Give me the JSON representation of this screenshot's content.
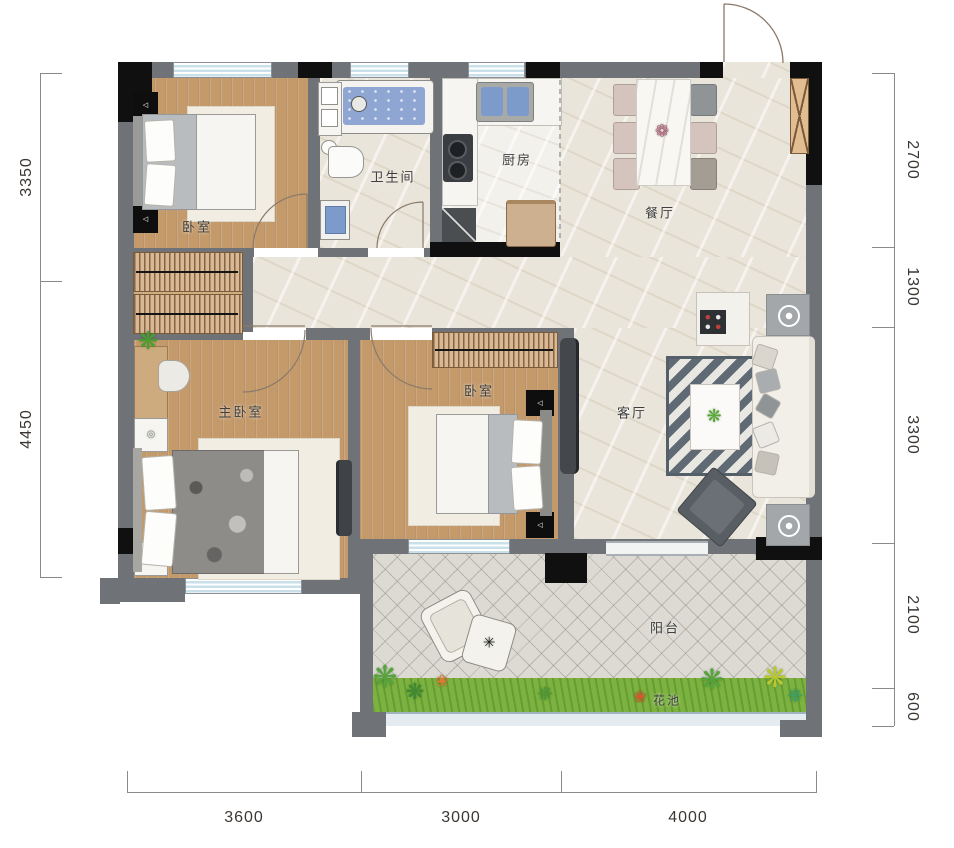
{
  "rooms": {
    "bedroom_top": "卧室",
    "bathroom": "卫生间",
    "kitchen": "厨房",
    "dining": "餐厅",
    "master_bedroom": "主卧室",
    "bedroom_mid": "卧室",
    "living_room": "客厅",
    "balcony": "阳台",
    "flower_bed": "花池"
  },
  "dimensions": {
    "left": [
      "3350",
      "4450"
    ],
    "right": [
      "2700",
      "1300",
      "3300",
      "2100",
      "600"
    ],
    "bottom": [
      "3600",
      "3000",
      "4000"
    ]
  },
  "icons": {
    "lamp": "◁",
    "plant": "❋",
    "flower": "❀",
    "table_star": "✳",
    "centerpiece": "❁",
    "desk_item": "◎"
  },
  "colors": {
    "wall": "#6f7378",
    "wall_black": "#101010",
    "wood_floor": "#c49a6b",
    "marble_floor": "#eae5da",
    "tile_floor": "#dcdad3",
    "grass": "#7cb23f",
    "water_blue": "#8fa6d3",
    "dimension_text": "#3c3733"
  }
}
